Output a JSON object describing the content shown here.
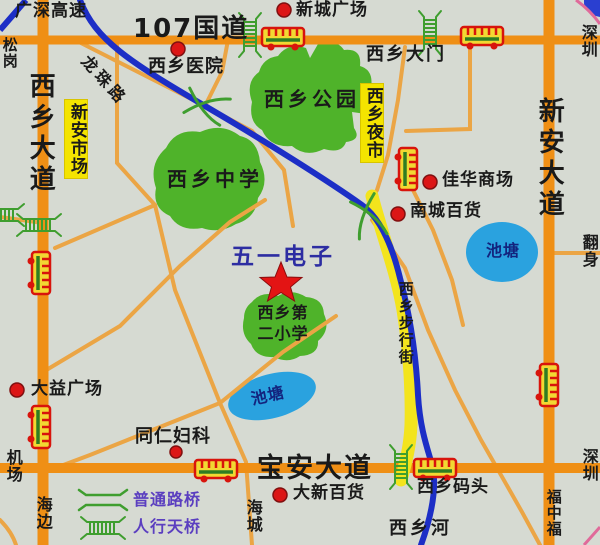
{
  "title": "西乡地图 (Xixiang area map)",
  "labels": {
    "expressway": "广深高速",
    "songgang": "松岗",
    "g107": "107国道",
    "xincheng_plaza": "新城广场",
    "hospital": "西乡医院",
    "longzhu_road": "龙珠路",
    "xixiang_gate": "西乡大门",
    "shenzhen_top": "深圳",
    "xixiang_avenue": "西乡大道",
    "xinan_market": "新安市场",
    "xixiang_park": "西乡公园",
    "night_market": "西乡夜市",
    "xinan_avenue": "新安大道",
    "jiahua_mall": "佳华商场",
    "nancheng_store": "南城百货",
    "middle_school": "西乡中学",
    "pond_right": "池塘",
    "fanshen": "翻身",
    "wuyi_electronics": "五一电子",
    "primary_school_line1": "西乡第",
    "primary_school_line2": "二小学",
    "pedestrian_street": "西乡步行街",
    "dayi_plaza": "大益广场",
    "pond_center": "池塘",
    "tongren": "同仁妇科",
    "airport": "机场",
    "seaside": "海边",
    "baoan_avenue": "宝安大道",
    "daxin_store": "大新百货",
    "wharf": "西乡码头",
    "haicheng": "海城",
    "river": "西乡河",
    "fuzhongfu": "福中福",
    "shenzhen_bottom": "深圳"
  },
  "legend": {
    "road_bridge": "普通路桥",
    "foot_bridge": "人行天桥"
  },
  "icons": {
    "bus_stop": "bus-icon",
    "foot_bridge": "pedestrian-bridge-icon",
    "road_bridge": "road-bridge-icon",
    "poi": "poi-dot-marker",
    "highlight": "star-icon"
  },
  "colors": {
    "background": "#d6dad2",
    "main_road_orange": "#ef8f15",
    "minor_road_tan": "#eba545",
    "blue_road_river": "#1c2ec6",
    "yellow_street": "#f3e41d",
    "green_area": "#4fb32a",
    "pond_blue": "#2aa2df",
    "label_yellow": "#f4e400",
    "poi_red": "#dc1616",
    "star_red": "#e31414",
    "legend_purple": "#5b3fc0",
    "wuyi_blue": "#2d2da2",
    "bridge_green": "#3f9e2f"
  }
}
